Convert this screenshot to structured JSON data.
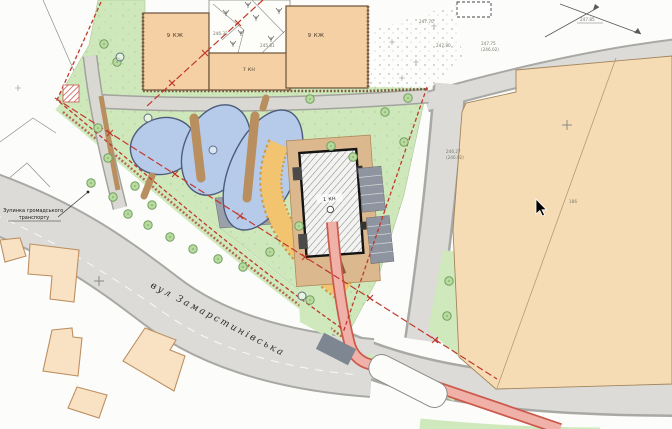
{
  "colors": {
    "park": "#cfe8bb",
    "pond": "#b6cbe9",
    "pond_outline": "#4e5b7d",
    "road": "#dcdbd7",
    "road_casing": "#a8a8a4",
    "building_tan": "#f4d0a4",
    "building_outline": "#6b5138",
    "block_tan": "#f6dcb4",
    "block_outline": "#a3865c",
    "footprint_tan": "#f9e2c4",
    "footprint_outline": "#bd8f60",
    "red": "#c0392b",
    "pink_lane": "#f0b2a8",
    "pink_casing": "#cc5a4c",
    "orange_zone": "#f3c470",
    "orange_zone_edge": "#cf9a45",
    "paving": "#dcb88e",
    "dark_plaza": "#99a0aa",
    "green_strip": "#cfe8bc",
    "dark_patch": "#7e8692",
    "brown_path": "#b98f60"
  },
  "map": {
    "street_label": "вул Замарстинівська",
    "bus_stop": {
      "line1": "Зупинка громадського",
      "line2": "транспорту"
    },
    "buildings": {
      "top_left": {
        "label": "9 КЖ"
      },
      "top_middle": {
        "label": "7 КН"
      },
      "top_right": {
        "label": "9 КЖ"
      },
      "new_building": {
        "label": "1 КН"
      }
    }
  },
  "annotations": {
    "elevation_labels": [
      {
        "text": "247.70",
        "x": 419,
        "y": 23
      },
      {
        "text": "247.80",
        "x": 436,
        "y": 47
      },
      {
        "text": "247.75",
        "x": 481,
        "y": 45
      },
      {
        "text": "(246.02)",
        "x": 481,
        "y": 51
      },
      {
        "text": "246.27",
        "x": 446,
        "y": 153
      },
      {
        "text": "(246.02)",
        "x": 446,
        "y": 159
      },
      {
        "text": "246.32",
        "x": 213,
        "y": 35
      },
      {
        "text": "245.81",
        "x": 260,
        "y": 47
      },
      {
        "text": "247.85",
        "x": 580,
        "y": 21
      },
      {
        "text": "186",
        "x": 569,
        "y": 203
      }
    ]
  },
  "cursor": {
    "x": 536,
    "y": 199
  }
}
